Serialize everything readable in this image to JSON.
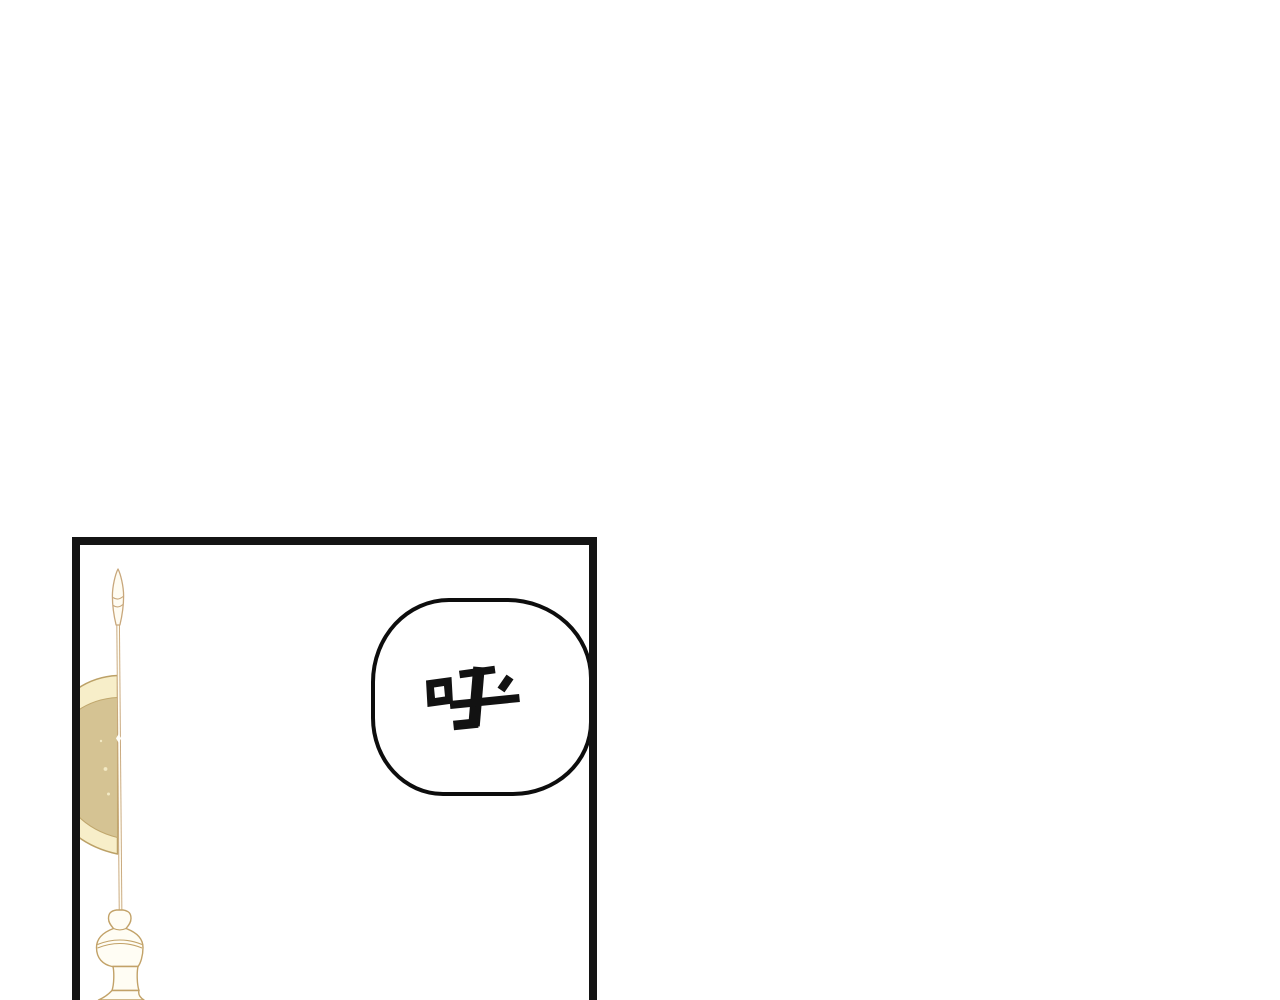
{
  "scene": {
    "type": "comic-page",
    "background_color": "#ffffff"
  },
  "panel": {
    "border_color": "#141414"
  },
  "speech_bubble": {
    "text": "呼",
    "fill_color": "#ffffff",
    "outline_color": "#0d0d0d"
  },
  "flag": {
    "banner_color": "#d5c393",
    "trim_color": "#f7eec9",
    "banner_outline_color": "#bca167",
    "pole_color": "#c8a77b",
    "pole_fill_color": "#fffdf3",
    "ornament_outline_color": "#c2a268"
  }
}
